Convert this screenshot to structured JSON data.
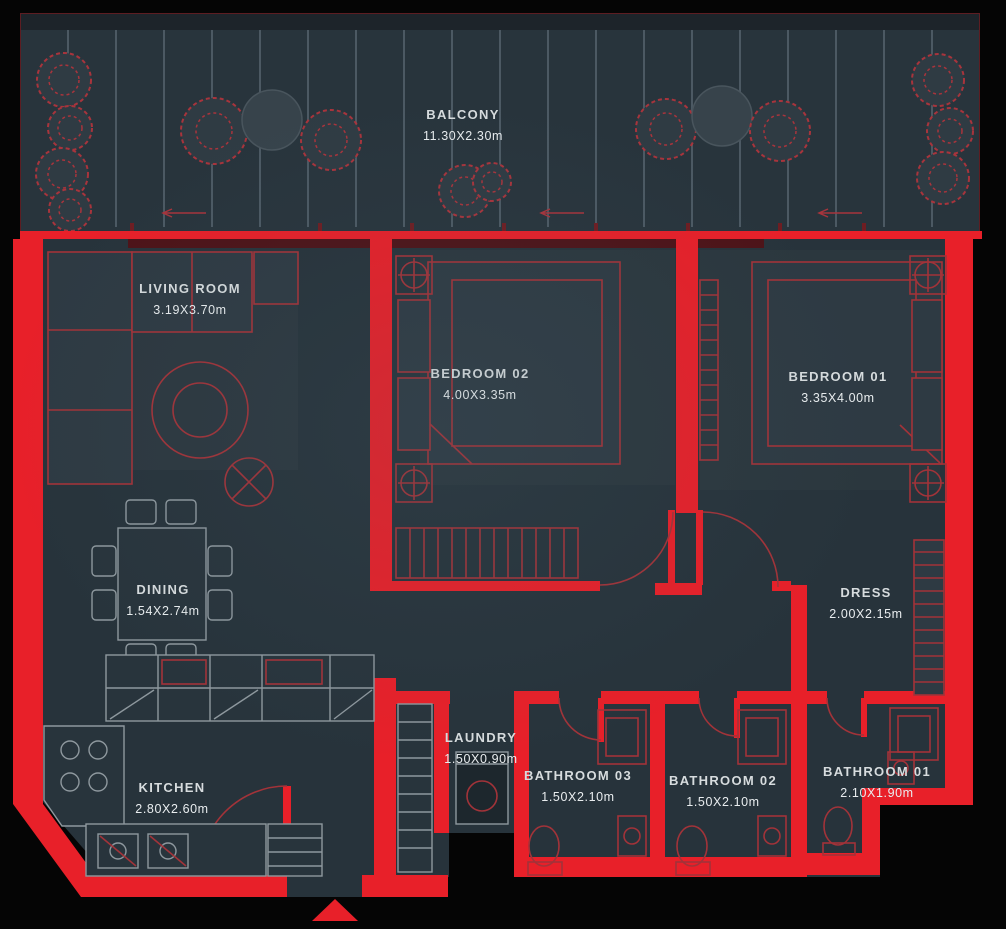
{
  "plan": {
    "type": "apartment-floor-plan",
    "colors": {
      "background": "#050505",
      "wall": "#e82029",
      "wall_dark": "#4d1318",
      "floor": "#27333b",
      "furniture_red": "#a23339",
      "furniture_grey": "#8e989e",
      "label_text": "#dde2e4"
    },
    "rooms": [
      {
        "id": "balcony",
        "name": "BALCONY",
        "dimensions": "11.30X2.30m"
      },
      {
        "id": "living-room",
        "name": "LIVING ROOM",
        "dimensions": "3.19X3.70m"
      },
      {
        "id": "bedroom-02",
        "name": "BEDROOM 02",
        "dimensions": "4.00X3.35m"
      },
      {
        "id": "bedroom-01",
        "name": "BEDROOM 01",
        "dimensions": "3.35X4.00m"
      },
      {
        "id": "dining",
        "name": "DINING",
        "dimensions": "1.54X2.74m"
      },
      {
        "id": "dress",
        "name": "DRESS",
        "dimensions": "2.00X2.15m"
      },
      {
        "id": "kitchen",
        "name": "KITCHEN",
        "dimensions": "2.80X2.60m"
      },
      {
        "id": "laundry",
        "name": "LAUNDRY",
        "dimensions": "1.50X0.90m"
      },
      {
        "id": "bathroom-03",
        "name": "BATHROOM 03",
        "dimensions": "1.50X2.10m"
      },
      {
        "id": "bathroom-02",
        "name": "BATHROOM 02",
        "dimensions": "1.50X2.10m"
      },
      {
        "id": "bathroom-01",
        "name": "BATHROOM 01",
        "dimensions": "2.10X1.90m"
      }
    ]
  }
}
